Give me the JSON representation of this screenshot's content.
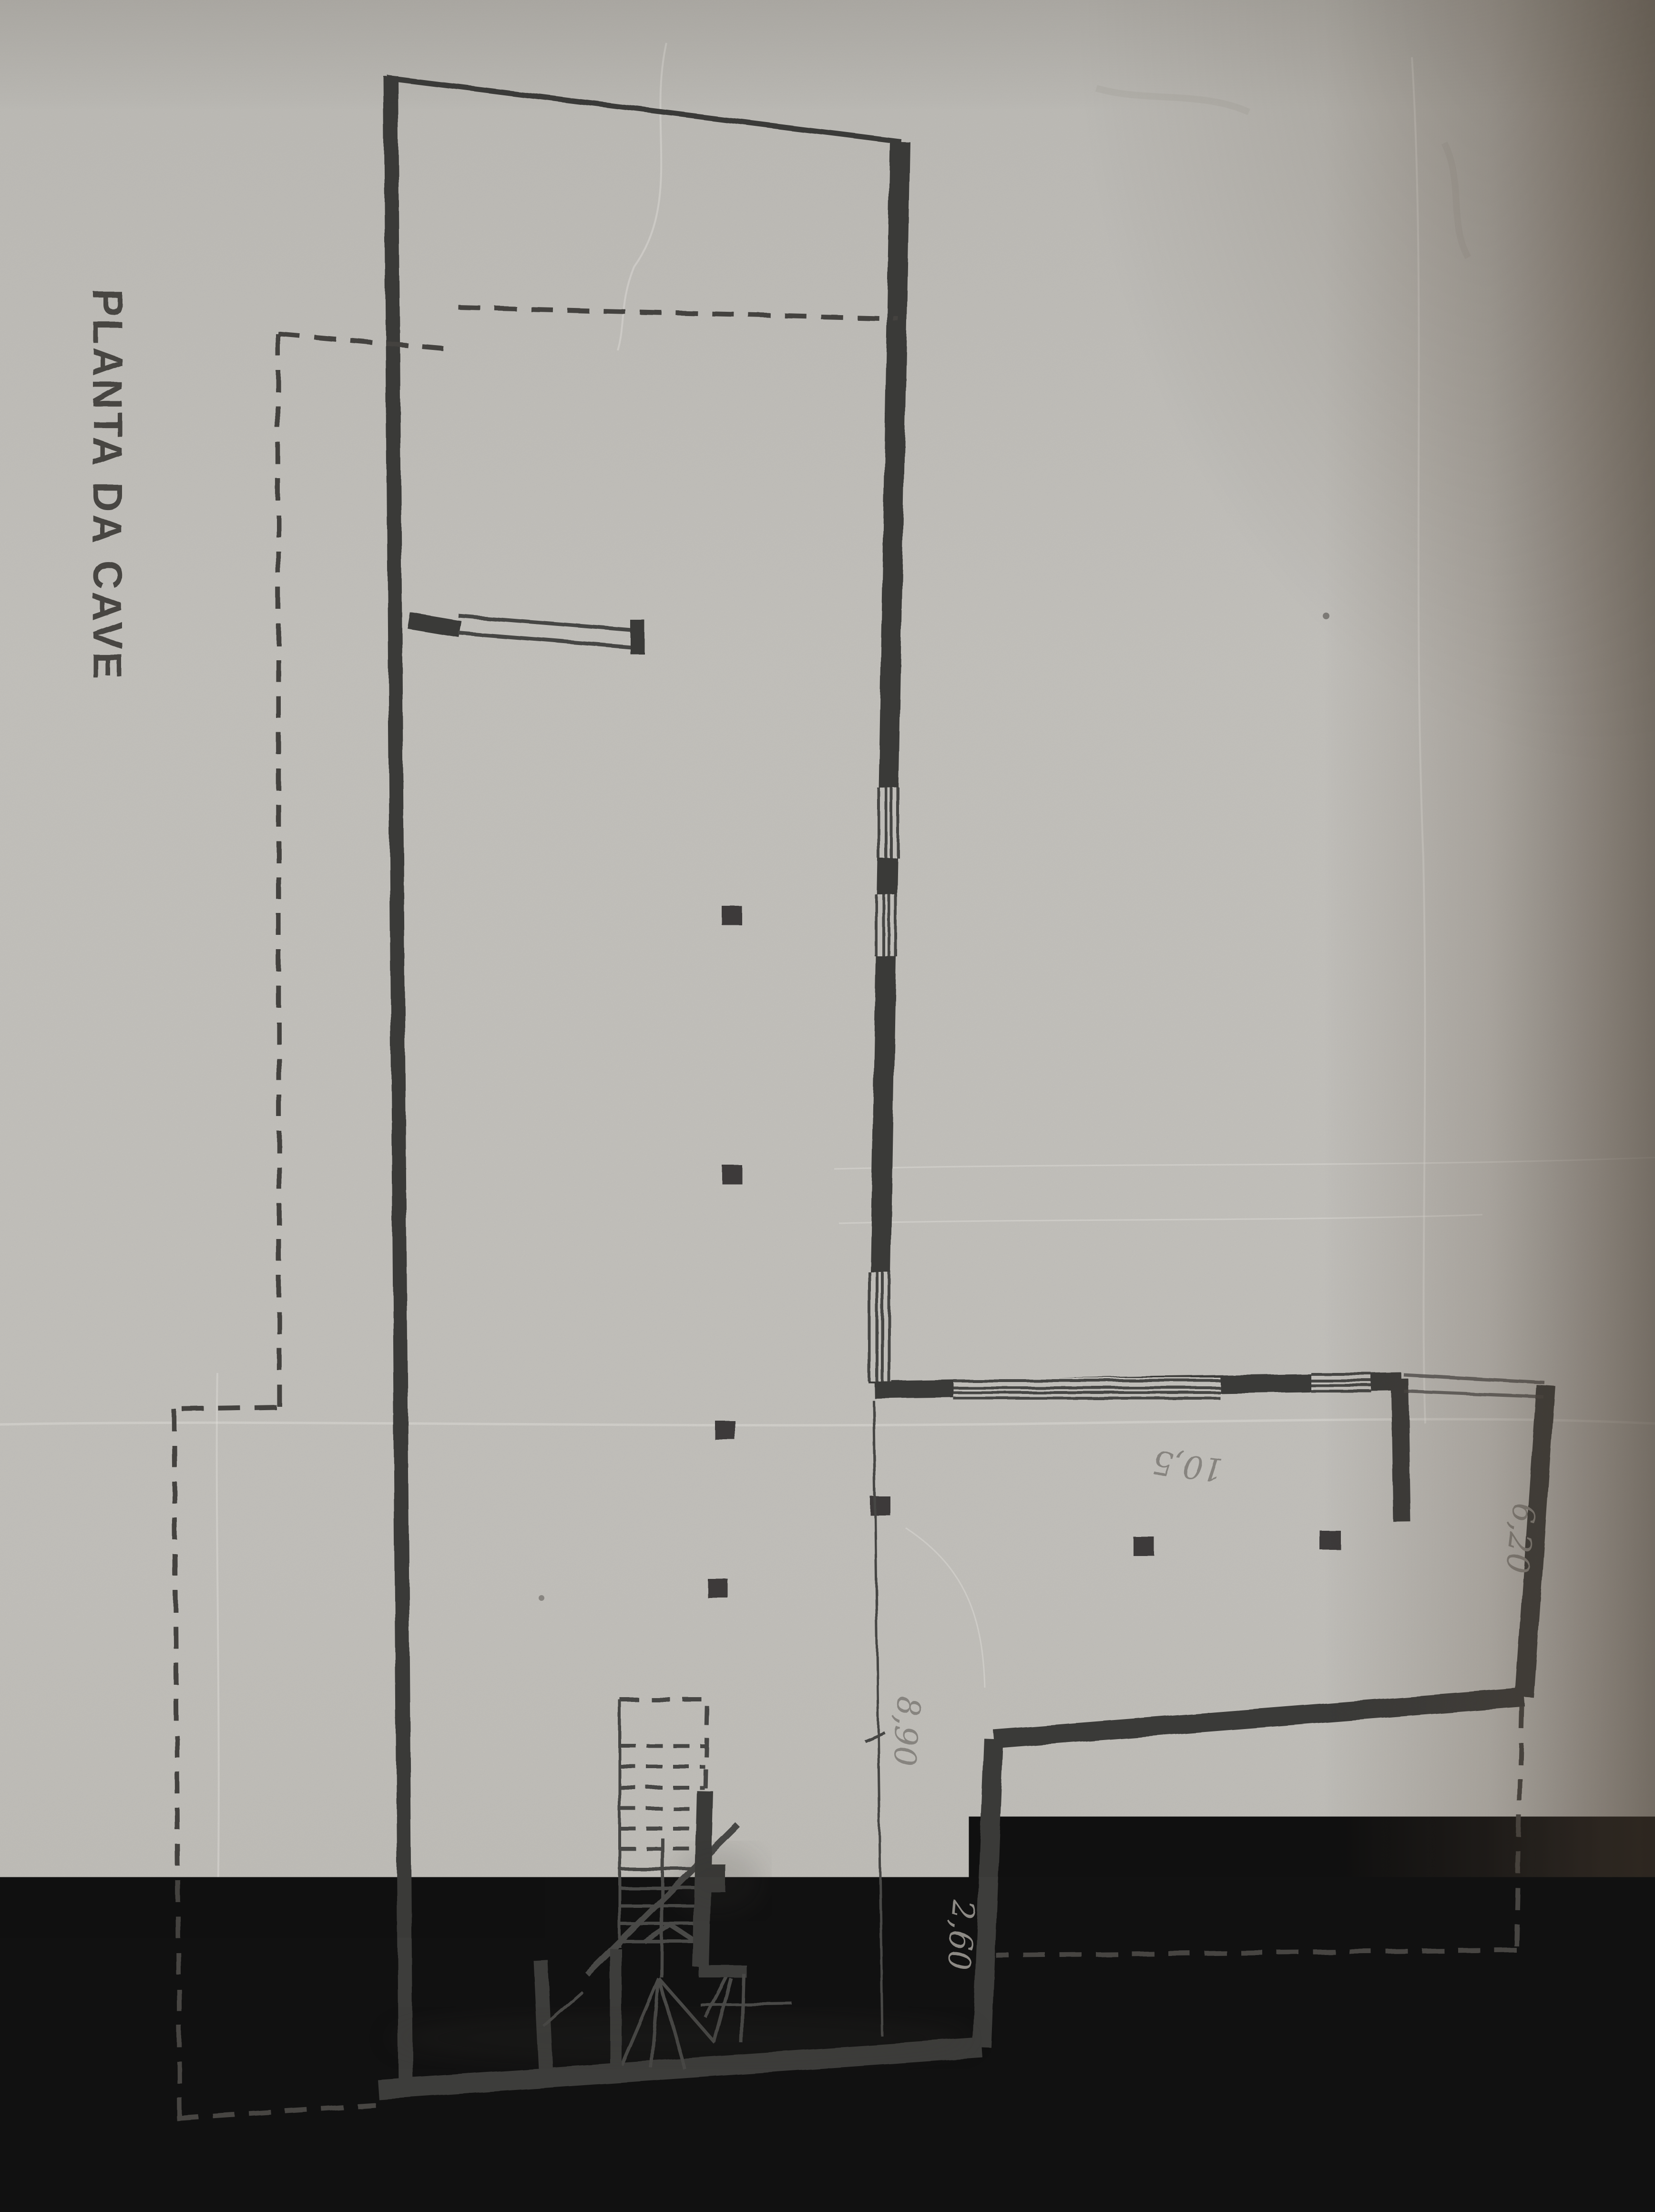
{
  "photo": {
    "description": "Photographed sheet with hand-drafted basement floor plan",
    "paper_color": "#c7c5c0",
    "ink_color": "#3e3c3a",
    "pencil_color": "#8d8a85",
    "edge_shadow_color": "#55473a"
  },
  "labels": {
    "title": "PLANTA DA CAVE",
    "dim_depth_main": "8,90",
    "dim_width_garage": "10,5",
    "dim_depth_garage": "6,20",
    "dim_step": "2,60"
  }
}
